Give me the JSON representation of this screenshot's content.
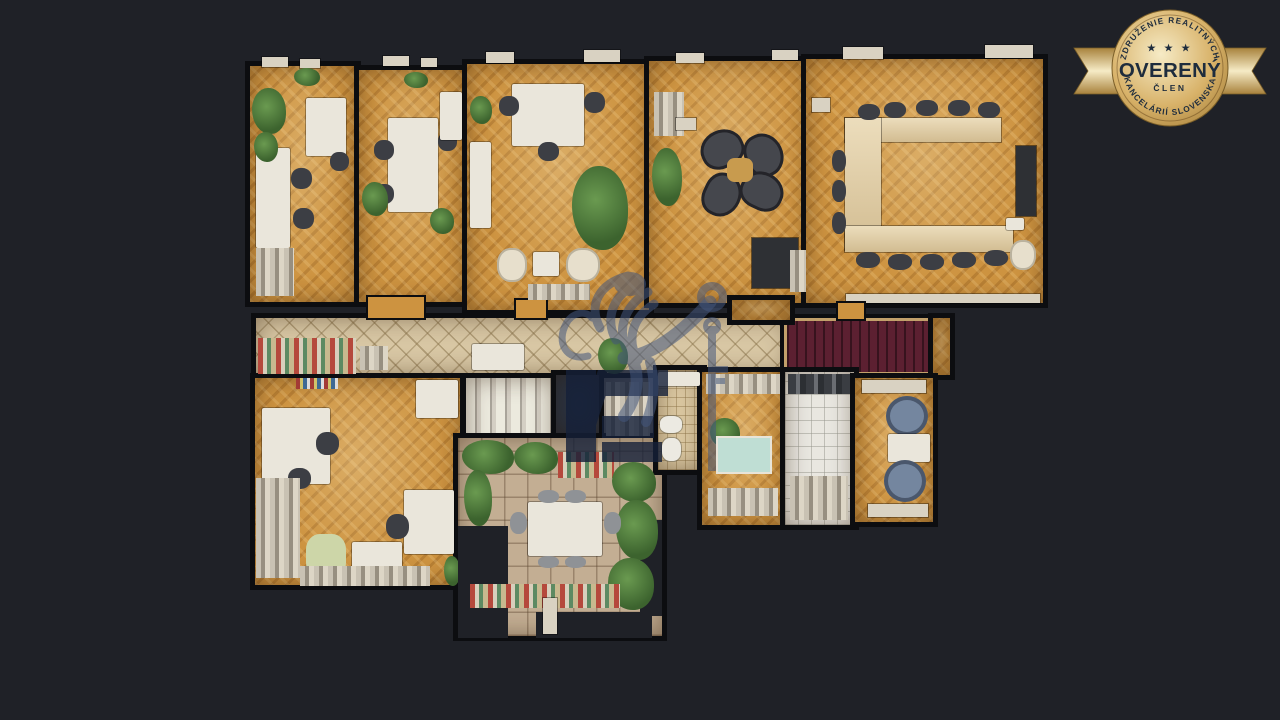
{
  "theme": {
    "background": "#1f2127",
    "wall": "#0c0d10",
    "wood": "#cd9340",
    "tile": "#d8c7a4",
    "stone": "#c3ae93",
    "stairs_red": "#5c2031",
    "gold": "#d8b269",
    "gold_light": "#f6ebc6",
    "gold_deep": "#a8823c",
    "badge_text": "#1e2c3d",
    "watermark_blue": "#44577d",
    "monogram": "#152039"
  },
  "badge": {
    "top_arc": "ZDRUŽENIE REALITNÝCH",
    "stars": "★ ★ ★",
    "title": "OVERENÝ",
    "subtitle": "ČLEN",
    "bottom_arc": "KANCELÁRIÍ SLOVENSKA"
  },
  "watermark": {
    "icon": "lion-holding-key-logo",
    "opacity": 0.55
  },
  "floorplan": {
    "description": "top-down 3D dollhouse scan of an office floor",
    "rooms": [
      {
        "id": "office-1",
        "floor": "wood",
        "x": 250,
        "y": 66,
        "w": 106,
        "h": 236
      },
      {
        "id": "office-2",
        "floor": "wood",
        "x": 359,
        "y": 70,
        "w": 106,
        "h": 232
      },
      {
        "id": "office-3",
        "floor": "wood",
        "x": 467,
        "y": 64,
        "w": 182,
        "h": 246
      },
      {
        "id": "lounge",
        "floor": "wood",
        "x": 649,
        "y": 61,
        "w": 160,
        "h": 242
      },
      {
        "id": "conference",
        "floor": "wood",
        "x": 806,
        "y": 59,
        "w": 237,
        "h": 244
      },
      {
        "id": "corridor",
        "floor": "tile",
        "x": 256,
        "y": 318,
        "w": 534,
        "h": 57
      },
      {
        "id": "staircase-red",
        "floor": "stairs",
        "x": 787,
        "y": 321,
        "w": 148,
        "h": 51
      },
      {
        "id": "corridor-end",
        "floor": "wood",
        "x": 933,
        "y": 318,
        "w": 17,
        "h": 57
      },
      {
        "id": "vestibule",
        "floor": "wood",
        "x": 732,
        "y": 300,
        "w": 58,
        "h": 20
      },
      {
        "id": "office-4",
        "floor": "wood",
        "x": 255,
        "y": 378,
        "w": 205,
        "h": 207
      },
      {
        "id": "stairwell",
        "floor": "steps",
        "x": 466,
        "y": 378,
        "w": 88,
        "h": 80
      },
      {
        "id": "skylight",
        "floor": "dark",
        "x": 556,
        "y": 375,
        "w": 46,
        "h": 58
      },
      {
        "id": "storage",
        "floor": "gray",
        "x": 604,
        "y": 378,
        "w": 50,
        "h": 64
      },
      {
        "id": "terrace",
        "floor": "stone",
        "x": 458,
        "y": 438,
        "w": 204,
        "h": 198
      },
      {
        "id": "bathroom",
        "floor": "tilebeige",
        "x": 658,
        "y": 370,
        "w": 44,
        "h": 100
      },
      {
        "id": "hall-small",
        "floor": "wood",
        "x": 702,
        "y": 372,
        "w": 83,
        "h": 153
      },
      {
        "id": "kitchen",
        "floor": "tilewhite",
        "x": 785,
        "y": 372,
        "w": 69,
        "h": 153
      },
      {
        "id": "office-5",
        "floor": "wood",
        "x": 855,
        "y": 378,
        "w": 78,
        "h": 144
      }
    ],
    "items": [
      {
        "t": "sill",
        "x": 262,
        "y": 57,
        "w": 26,
        "h": 10
      },
      {
        "t": "sill",
        "x": 300,
        "y": 59,
        "w": 20,
        "h": 9
      },
      {
        "t": "sill",
        "x": 383,
        "y": 56,
        "w": 26,
        "h": 10
      },
      {
        "t": "sill",
        "x": 421,
        "y": 58,
        "w": 16,
        "h": 9
      },
      {
        "t": "sill",
        "x": 486,
        "y": 52,
        "w": 28,
        "h": 11
      },
      {
        "t": "sill",
        "x": 584,
        "y": 50,
        "w": 36,
        "h": 12
      },
      {
        "t": "sill",
        "x": 676,
        "y": 53,
        "w": 28,
        "h": 10
      },
      {
        "t": "sill",
        "x": 772,
        "y": 50,
        "w": 26,
        "h": 10
      },
      {
        "t": "sill",
        "x": 843,
        "y": 47,
        "w": 40,
        "h": 12
      },
      {
        "t": "sill",
        "x": 985,
        "y": 45,
        "w": 48,
        "h": 13
      },
      {
        "t": "strip",
        "x": 846,
        "y": 294,
        "w": 194,
        "h": 9
      },
      {
        "t": "wood-tab",
        "x": 368,
        "y": 297,
        "w": 56,
        "h": 21
      },
      {
        "t": "wood-tab",
        "x": 516,
        "y": 300,
        "w": 30,
        "h": 18
      },
      {
        "t": "wood-tab",
        "x": 838,
        "y": 303,
        "w": 26,
        "h": 16
      },
      {
        "t": "desk",
        "x": 256,
        "y": 148,
        "w": 34,
        "h": 100
      },
      {
        "t": "desk",
        "x": 306,
        "y": 98,
        "w": 40,
        "h": 58
      },
      {
        "t": "chair-dark",
        "x": 291,
        "y": 168,
        "w": 21,
        "h": 21
      },
      {
        "t": "chair-dark",
        "x": 293,
        "y": 208,
        "w": 21,
        "h": 21
      },
      {
        "t": "chair-dark",
        "x": 330,
        "y": 152,
        "w": 19,
        "h": 19
      },
      {
        "t": "plant",
        "x": 252,
        "y": 88,
        "w": 34,
        "h": 46
      },
      {
        "t": "plant",
        "x": 294,
        "y": 68,
        "w": 26,
        "h": 18
      },
      {
        "t": "plant",
        "x": 254,
        "y": 132,
        "w": 24,
        "h": 30
      },
      {
        "t": "clutter",
        "x": 256,
        "y": 248,
        "w": 38,
        "h": 48
      },
      {
        "t": "desk",
        "x": 388,
        "y": 118,
        "w": 50,
        "h": 94
      },
      {
        "t": "chair-dark",
        "x": 374,
        "y": 140,
        "w": 20,
        "h": 20
      },
      {
        "t": "chair-dark",
        "x": 374,
        "y": 184,
        "w": 20,
        "h": 20
      },
      {
        "t": "chair-dark",
        "x": 438,
        "y": 132,
        "w": 19,
        "h": 19
      },
      {
        "t": "plant",
        "x": 404,
        "y": 72,
        "w": 24,
        "h": 16
      },
      {
        "t": "plant",
        "x": 362,
        "y": 182,
        "w": 26,
        "h": 34
      },
      {
        "t": "plant",
        "x": 430,
        "y": 208,
        "w": 24,
        "h": 26
      },
      {
        "t": "counter",
        "x": 440,
        "y": 92,
        "w": 22,
        "h": 48
      },
      {
        "t": "desk",
        "x": 512,
        "y": 84,
        "w": 72,
        "h": 62
      },
      {
        "t": "chair-dark",
        "x": 499,
        "y": 96,
        "w": 20,
        "h": 20
      },
      {
        "t": "chair-dark",
        "x": 584,
        "y": 92,
        "w": 21,
        "h": 21
      },
      {
        "t": "chair-dark",
        "x": 538,
        "y": 142,
        "w": 21,
        "h": 19
      },
      {
        "t": "counter",
        "x": 470,
        "y": 142,
        "w": 21,
        "h": 86
      },
      {
        "t": "plant",
        "x": 470,
        "y": 96,
        "w": 22,
        "h": 28
      },
      {
        "t": "plant",
        "x": 572,
        "y": 166,
        "w": 56,
        "h": 84
      },
      {
        "t": "chair-cream",
        "x": 497,
        "y": 248,
        "w": 30,
        "h": 34
      },
      {
        "t": "chair-cream",
        "x": 566,
        "y": 248,
        "w": 34,
        "h": 34
      },
      {
        "t": "table-white",
        "x": 533,
        "y": 252,
        "w": 26,
        "h": 24
      },
      {
        "t": "clutter",
        "x": 528,
        "y": 284,
        "w": 62,
        "h": 16
      },
      {
        "t": "plant",
        "x": 652,
        "y": 148,
        "w": 30,
        "h": 58
      },
      {
        "t": "clutter",
        "x": 654,
        "y": 92,
        "w": 30,
        "h": 44
      },
      {
        "t": "sill",
        "x": 676,
        "y": 118,
        "w": 20,
        "h": 12
      },
      {
        "t": "chair-dark2",
        "x": 700,
        "y": 130,
        "w": 44,
        "h": 38,
        "r": -25
      },
      {
        "t": "chair-dark2",
        "x": 742,
        "y": 136,
        "w": 44,
        "h": 38,
        "r": 65
      },
      {
        "t": "chair-dark2",
        "x": 700,
        "y": 176,
        "w": 44,
        "h": 38,
        "r": 115
      },
      {
        "t": "chair-dark2",
        "x": 740,
        "y": 172,
        "w": 44,
        "h": 38,
        "r": 25
      },
      {
        "t": "table-gold",
        "x": 727,
        "y": 158,
        "w": 26,
        "h": 24
      },
      {
        "t": "table-dark",
        "x": 752,
        "y": 238,
        "w": 46,
        "h": 50
      },
      {
        "t": "clutter",
        "x": 790,
        "y": 250,
        "w": 16,
        "h": 42
      },
      {
        "t": "ctable",
        "x": 845,
        "y": 118,
        "w": 156,
        "h": 24
      },
      {
        "t": "ctable",
        "x": 845,
        "y": 118,
        "w": 36,
        "h": 132
      },
      {
        "t": "ctable",
        "x": 845,
        "y": 226,
        "w": 168,
        "h": 26
      },
      {
        "t": "chair-dark",
        "x": 858,
        "y": 104,
        "w": 22,
        "h": 16
      },
      {
        "t": "chair-dark",
        "x": 884,
        "y": 102,
        "w": 22,
        "h": 16
      },
      {
        "t": "chair-dark",
        "x": 916,
        "y": 100,
        "w": 22,
        "h": 16
      },
      {
        "t": "chair-dark",
        "x": 948,
        "y": 100,
        "w": 22,
        "h": 16
      },
      {
        "t": "chair-dark",
        "x": 978,
        "y": 102,
        "w": 22,
        "h": 16
      },
      {
        "t": "chair-dark",
        "x": 856,
        "y": 252,
        "w": 24,
        "h": 16
      },
      {
        "t": "chair-dark",
        "x": 888,
        "y": 254,
        "w": 24,
        "h": 16
      },
      {
        "t": "chair-dark",
        "x": 920,
        "y": 254,
        "w": 24,
        "h": 16
      },
      {
        "t": "chair-dark",
        "x": 952,
        "y": 252,
        "w": 24,
        "h": 16
      },
      {
        "t": "chair-dark",
        "x": 984,
        "y": 250,
        "w": 24,
        "h": 16
      },
      {
        "t": "chair-dark",
        "x": 832,
        "y": 150,
        "w": 14,
        "h": 22
      },
      {
        "t": "chair-dark",
        "x": 832,
        "y": 180,
        "w": 14,
        "h": 22
      },
      {
        "t": "chair-dark",
        "x": 832,
        "y": 212,
        "w": 14,
        "h": 22
      },
      {
        "t": "tv",
        "x": 1016,
        "y": 146,
        "w": 20,
        "h": 70
      },
      {
        "t": "counter",
        "x": 1006,
        "y": 218,
        "w": 18,
        "h": 12
      },
      {
        "t": "chair-cream",
        "x": 1010,
        "y": 240,
        "w": 26,
        "h": 30
      },
      {
        "t": "sill",
        "x": 812,
        "y": 98,
        "w": 18,
        "h": 14
      },
      {
        "t": "clutter-color",
        "x": 258,
        "y": 338,
        "w": 98,
        "h": 36
      },
      {
        "t": "clutter",
        "x": 360,
        "y": 346,
        "w": 28,
        "h": 24
      },
      {
        "t": "counter",
        "x": 472,
        "y": 344,
        "w": 52,
        "h": 26
      },
      {
        "t": "plant",
        "x": 598,
        "y": 338,
        "w": 30,
        "h": 36
      },
      {
        "t": "shelf-books",
        "x": 296,
        "y": 378,
        "w": 42,
        "h": 11
      },
      {
        "t": "desk",
        "x": 262,
        "y": 408,
        "w": 68,
        "h": 76
      },
      {
        "t": "chair-dark",
        "x": 316,
        "y": 432,
        "w": 23,
        "h": 23
      },
      {
        "t": "chair-dark",
        "x": 288,
        "y": 468,
        "w": 23,
        "h": 21
      },
      {
        "t": "clutter",
        "x": 256,
        "y": 478,
        "w": 44,
        "h": 100
      },
      {
        "t": "chair-green",
        "x": 306,
        "y": 534,
        "w": 40,
        "h": 44
      },
      {
        "t": "table-white",
        "x": 352,
        "y": 542,
        "w": 50,
        "h": 42
      },
      {
        "t": "desk",
        "x": 404,
        "y": 490,
        "w": 50,
        "h": 64
      },
      {
        "t": "chair-dark",
        "x": 386,
        "y": 514,
        "w": 23,
        "h": 25
      },
      {
        "t": "counter",
        "x": 416,
        "y": 380,
        "w": 42,
        "h": 38
      },
      {
        "t": "clutter",
        "x": 300,
        "y": 566,
        "w": 130,
        "h": 20
      },
      {
        "t": "plant",
        "x": 444,
        "y": 556,
        "w": 16,
        "h": 30
      },
      {
        "t": "clutter",
        "x": 606,
        "y": 382,
        "w": 44,
        "h": 54
      },
      {
        "t": "hole",
        "x": 458,
        "y": 526,
        "w": 50,
        "h": 112
      },
      {
        "t": "hole",
        "x": 536,
        "y": 612,
        "w": 116,
        "h": 26
      },
      {
        "t": "hole",
        "x": 640,
        "y": 520,
        "w": 22,
        "h": 96
      },
      {
        "t": "plant",
        "x": 462,
        "y": 440,
        "w": 52,
        "h": 34
      },
      {
        "t": "plant",
        "x": 514,
        "y": 442,
        "w": 44,
        "h": 32
      },
      {
        "t": "clutter-color",
        "x": 558,
        "y": 452,
        "w": 56,
        "h": 26
      },
      {
        "t": "plant",
        "x": 612,
        "y": 462,
        "w": 44,
        "h": 40
      },
      {
        "t": "plant",
        "x": 616,
        "y": 500,
        "w": 42,
        "h": 60
      },
      {
        "t": "plant",
        "x": 608,
        "y": 558,
        "w": 46,
        "h": 52
      },
      {
        "t": "plant",
        "x": 464,
        "y": 470,
        "w": 28,
        "h": 56
      },
      {
        "t": "clutter-color",
        "x": 470,
        "y": 584,
        "w": 150,
        "h": 24
      },
      {
        "t": "table-white",
        "x": 528,
        "y": 502,
        "w": 74,
        "h": 54
      },
      {
        "t": "chair-gray",
        "x": 510,
        "y": 512,
        "w": 17,
        "h": 22
      },
      {
        "t": "chair-gray",
        "x": 604,
        "y": 512,
        "w": 17,
        "h": 22
      },
      {
        "t": "chair-gray",
        "x": 538,
        "y": 490,
        "w": 21,
        "h": 13
      },
      {
        "t": "chair-gray",
        "x": 565,
        "y": 490,
        "w": 21,
        "h": 13
      },
      {
        "t": "chair-gray",
        "x": 538,
        "y": 556,
        "w": 21,
        "h": 12
      },
      {
        "t": "chair-gray",
        "x": 565,
        "y": 556,
        "w": 21,
        "h": 12
      },
      {
        "t": "sill",
        "x": 543,
        "y": 598,
        "w": 14,
        "h": 36
      },
      {
        "t": "counter",
        "x": 658,
        "y": 372,
        "w": 42,
        "h": 14
      },
      {
        "t": "fixture",
        "x": 660,
        "y": 416,
        "w": 22,
        "h": 17
      },
      {
        "t": "fixture",
        "x": 662,
        "y": 438,
        "w": 19,
        "h": 23
      },
      {
        "t": "clutter",
        "x": 706,
        "y": 374,
        "w": 74,
        "h": 20
      },
      {
        "t": "plant",
        "x": 710,
        "y": 418,
        "w": 30,
        "h": 30
      },
      {
        "t": "table-teal",
        "x": 718,
        "y": 438,
        "w": 52,
        "h": 34
      },
      {
        "t": "clutter",
        "x": 708,
        "y": 488,
        "w": 70,
        "h": 28
      },
      {
        "t": "clutter-dark",
        "x": 788,
        "y": 374,
        "w": 62,
        "h": 20
      },
      {
        "t": "clutter",
        "x": 790,
        "y": 476,
        "w": 58,
        "h": 44
      },
      {
        "t": "sill",
        "x": 862,
        "y": 380,
        "w": 64,
        "h": 13
      },
      {
        "t": "chair-blue",
        "x": 886,
        "y": 396,
        "w": 42,
        "h": 40
      },
      {
        "t": "table-white",
        "x": 888,
        "y": 434,
        "w": 42,
        "h": 28
      },
      {
        "t": "chair-blue",
        "x": 884,
        "y": 460,
        "w": 42,
        "h": 42
      },
      {
        "t": "sill",
        "x": 868,
        "y": 504,
        "w": 60,
        "h": 13
      }
    ]
  }
}
